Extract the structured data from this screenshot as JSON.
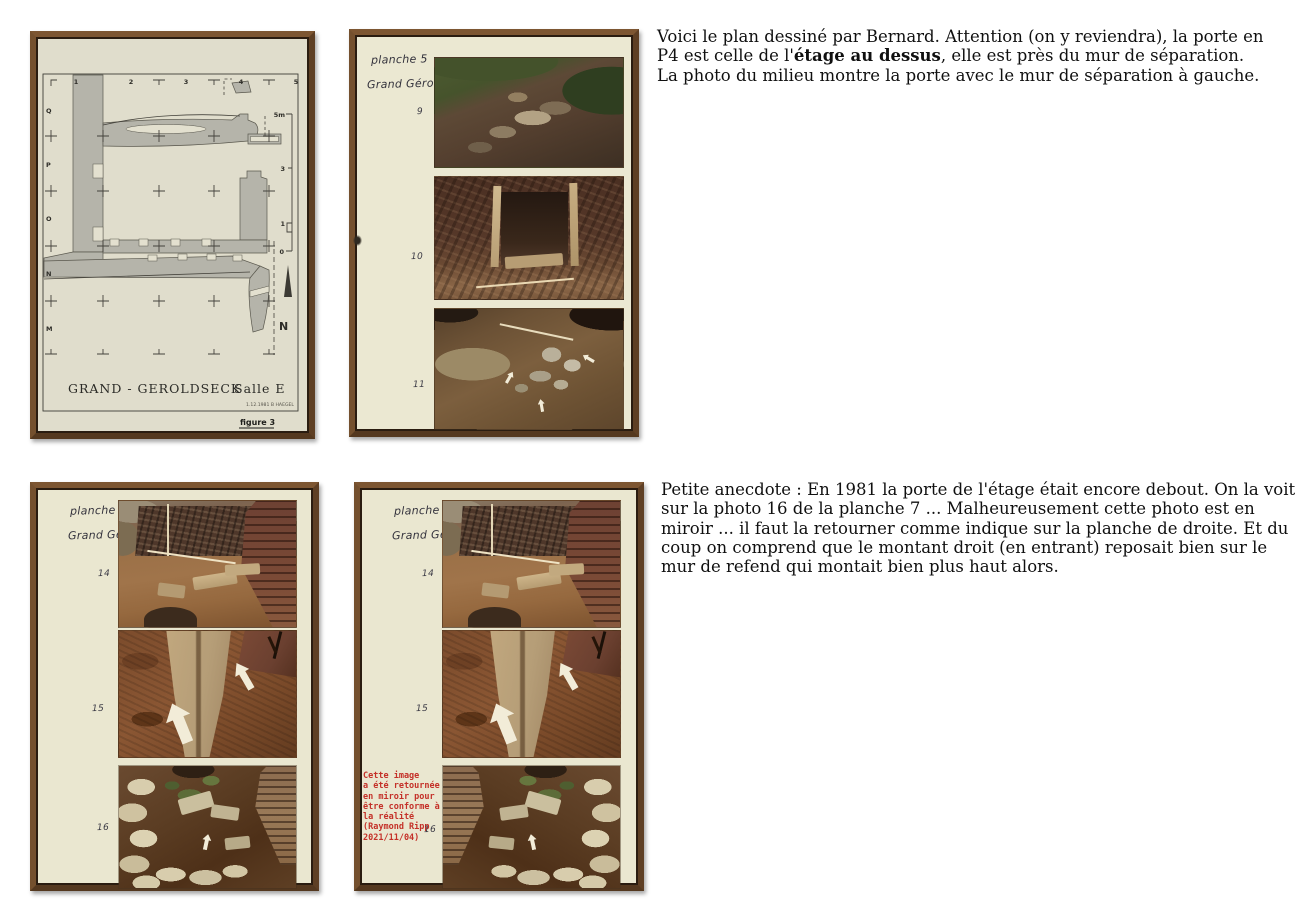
{
  "figure3": {
    "grid_numbers": [
      "1",
      "2",
      "3",
      "4",
      "5"
    ],
    "grid_letters": [
      "Q",
      "P",
      "O",
      "N",
      "M"
    ],
    "scale": {
      "top": "5m",
      "mid": "3",
      "low": "1",
      "zero": "0"
    },
    "north": "N",
    "title": "GRAND - GEROLDSECK",
    "room": "Salle E",
    "credit": "1.12.1981 B HAEGEL",
    "caption": "figure 3"
  },
  "planche5": {
    "label": "planche 5",
    "site": "Grand Géroldseck",
    "photos": [
      "9",
      "10",
      "11"
    ]
  },
  "planche7_left": {
    "label": "planche 7",
    "site": "Grand Géroldseck",
    "photos": [
      "14",
      "15",
      "16"
    ]
  },
  "planche7_right": {
    "label": "planche 7",
    "site": "Grand Géroldseck",
    "photos": [
      "14",
      "15",
      "16"
    ],
    "mirror_note": [
      "Cette image",
      "a été retournée",
      "en miroir pour",
      "être conforme à",
      "la réalité",
      "(Raymond Ripp",
      "2021/11/04)"
    ]
  },
  "commentary_top": {
    "lead": "Voici le plan dessiné par Bernard. Attention (on y reviendra), la porte en P4 est celle de l'",
    "bold": "étage au dessus",
    "tail": ", elle est près du mur de séparation.",
    "line2": "La photo du milieu montre la porte avec le mur de séparation à gauche."
  },
  "commentary_bottom": {
    "text": "Petite anecdote : En 1981 la porte de l'étage était encore debout. On la voit sur la photo 16 de la planche 7 ... Malheureusement cette photo est en miroir ... il faut la retourner comme indique sur la planche de droite. Et du coup on comprend que le montant droit (en entrant) reposait bien sur le mur de refend qui montait bien plus haut alors."
  },
  "colors": {
    "frame_brown": "#6e4a28",
    "plan_paper": "#e0ddcc",
    "planche_paper": "#ebe8d2",
    "wall_gray": "#b5b4aa",
    "note_red": "#c43028"
  }
}
